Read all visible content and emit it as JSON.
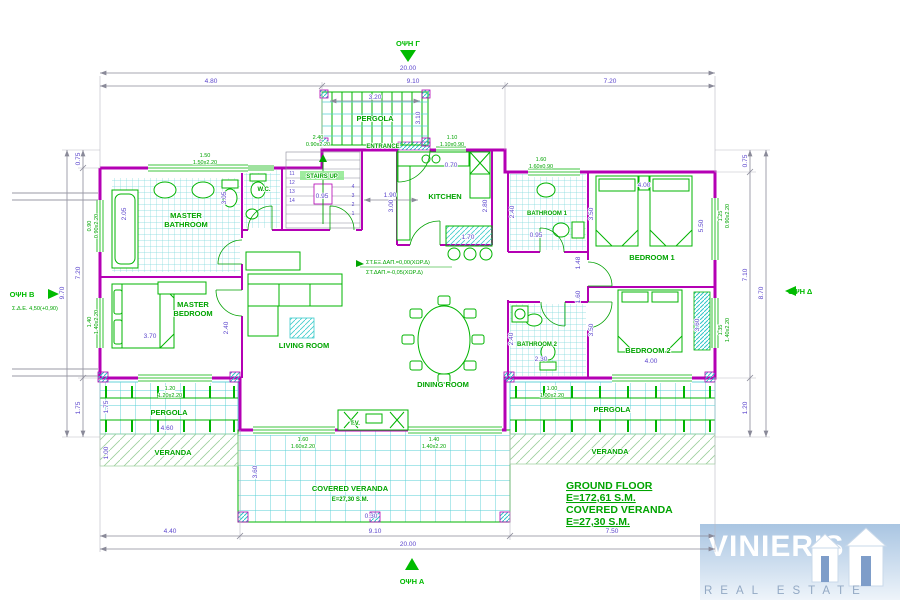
{
  "views": {
    "top": "ΟΨΗ Γ",
    "bottom": "ΟΨΗ Α",
    "left": "ΟΨΗ Β",
    "right": "ΟΨΗ Δ"
  },
  "rooms": {
    "master_bath_1": "MASTER",
    "master_bath_2": "BATHROOM",
    "wc": "W.C.",
    "stairs": "STAIRS UP",
    "pergola_top": "PERGOLA",
    "entrance": "ENTRANCE",
    "kitchen": "KITCHEN",
    "bathroom1": "BATHROOM 1",
    "bedroom1": "BEDROOM 1",
    "master_bed_1": "MASTER",
    "master_bed_2": "BEDROOM",
    "living": "LIVING ROOM",
    "dining": "DINING ROOM",
    "bathroom2": "BATHROOM 2",
    "bedroom2": "BEDROOM 2",
    "pergola_left": "PERGOLA",
    "pergola_right": "PERGOLA",
    "veranda_left": "VERANDA",
    "veranda_right": "VERANDA",
    "covered_1": "COVERED VERANDA",
    "covered_2": "E=27,30 S.M.",
    "tv": "T.V."
  },
  "summary": {
    "line1": "GROUND FLOOR",
    "line2": "E=172,61 S.M.",
    "line3": "COVERED VERANDA",
    "line4": "E=27,30 S.M."
  },
  "notes": {
    "left_sub": "Σ.Δ.Ε. 4,50(+0,90)",
    "level1": "ΣΤ.ΕΞ.ΔΑΠ.=0,00(ΧΩΡ.Δ)",
    "level2": "ΣΤ.ΔΑΠ.=-0,05(ΧΩΡ.Δ)"
  },
  "dims": {
    "top_total": "20.00",
    "top_left": "4.80",
    "top_mid": "9.10",
    "top_right": "7.20",
    "bottom_left": "4.40",
    "bottom_mid": "9.10",
    "bottom_right": "7.50",
    "bottom_total": "20.00",
    "left_top": "0.75",
    "left_mid": "7.20",
    "left_bottom": "1.75",
    "left_total": "9.70",
    "right_top": "0.75",
    "right_mid": "7.10",
    "right_bottom": "1.20",
    "right_total": "8.70",
    "pergola_w": "3.20",
    "pergola_d": "3.10",
    "mb_w": "2.05",
    "mb_h": "3.05",
    "mbed_w": "3.70",
    "mbed_side": "2.40",
    "stairs_mid": "0.95",
    "stairs_side": "1.90",
    "kit_h": "3.00",
    "kit_top": "0.70",
    "kit_island": "1.70",
    "kit_r": "2.80",
    "b1_w": "2.40",
    "b1_h": "3.50",
    "b1_door": "0.95",
    "bd1_w": "4.00",
    "bd1_h": "5.50",
    "cor_a": "1.48",
    "cor_b": "1.60",
    "bd2_w": "4.00",
    "bd2_h": "3.60",
    "bd2_l": "3.50",
    "b2_w": "2.40",
    "b2_b": "2.30",
    "cv_d": "3.60",
    "cv_step": "0.30",
    "pl_w": "4.60",
    "pl_d": "1.75",
    "pl_s": "1.00"
  },
  "windows": {
    "w1": [
      "1.50",
      "1.50x2.20"
    ],
    "w2": [
      "2.40",
      "0.90x2.20"
    ],
    "w3": [
      "1.10",
      "1.10x0.90"
    ],
    "w4": [
      "1.60",
      "1.60x0.90"
    ],
    "w5": [
      "1.60",
      "1.60x2.20"
    ],
    "w6": [
      "1.40",
      "1.40x2.20"
    ],
    "w7": [
      "1.20",
      "1.20x2.20"
    ],
    "w8": [
      "1.00",
      "1.00x2.20"
    ],
    "w9": [
      "0.90",
      "0.90x2.20"
    ],
    "w10": [
      "1.40",
      "1.40x2.20"
    ],
    "w11": [
      "1.25",
      "0.90x2.20"
    ],
    "w12": [
      "1.35",
      "1.40x2.20"
    ]
  },
  "stair_numbers": [
    "11",
    "12",
    "13",
    "14",
    "4",
    "3",
    "2",
    "1"
  ],
  "colors": {
    "wall": "#b400b4",
    "annotation": "#00a400",
    "dimension": "#5b45cc",
    "tile": "#7fd8dc",
    "logo_bg": "#a9c5e2"
  },
  "logo": {
    "name": "VINIERIS",
    "tagline": "REAL ESTATE"
  }
}
